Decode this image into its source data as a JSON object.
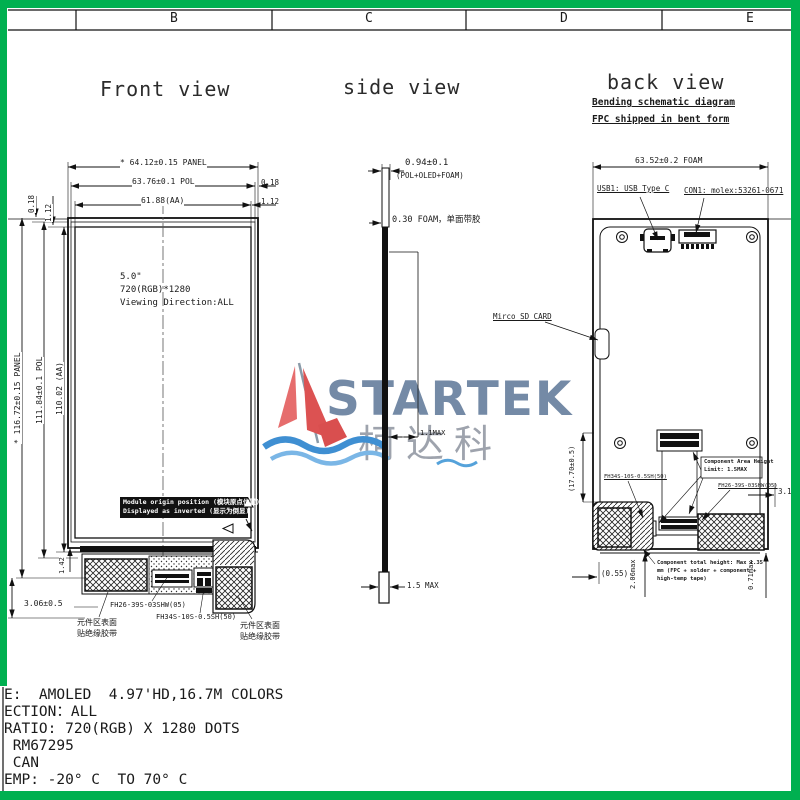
{
  "sheet": {
    "border_color": "#00b050",
    "columns": [
      "B",
      "C",
      "D",
      "E"
    ]
  },
  "front": {
    "title": "Front view",
    "size_label": "5.0\"",
    "resolution": "720(RGB)*1280",
    "viewing": "Viewing Direction:ALL",
    "dim_panel_w": "* 64.12±0.15 PANEL",
    "dim_pol_w": "63.76±0.1 POL",
    "dim_aa_w": "61.88(AA)",
    "gap_right_pol": "0.18",
    "gap_right_aa": "1.12",
    "gap_left_pol": "0.18",
    "gap_left_aa": "1.12",
    "dim_panel_h": "* 116.72±0.15 PANEL",
    "dim_pol_h": "111.84±0.1 POL",
    "dim_aa_h": "110.02 (AA)",
    "dim_ledge": "1.42",
    "dim_bottom": "15.12±0.5",
    "dim_tail": "3.06±0.5",
    "origin_line1": "Module origin position (模块原点位置)",
    "origin_line2": "Displayed as inverted (显示为倒显)",
    "conn1": "FH26-39S-03SHW(05)",
    "conn2": "FH34S-10S-0.5SH(50)",
    "tape_left_l1": "元件区表面",
    "tape_left_l2": "贴绝缘胶带",
    "tape_right_l1": "元件区表面",
    "tape_right_l2": "贴绝缘胶带"
  },
  "side": {
    "title": "side view",
    "dim_stack": "0.94±0.1",
    "dim_stack_sub": "(POL+OLED+FOAM)",
    "foam_note": "0.30 FOAM，单面带胶",
    "dim_mid": "1.1MAX",
    "dim_bottom": "1.5 MAX"
  },
  "back": {
    "title": "back view",
    "subtitle1": "Bending schematic diagram",
    "subtitle2": "FPC shipped in bent form",
    "dim_foam_w": "63.52±0.2 FOAM",
    "usb_label": "USB1: USB Type C",
    "con_label": "CON1: molex:53261-0671",
    "sd_label": "Mirco SD CARD",
    "dim_side": "(17.70±0.5)",
    "comp_area_l1": "Component Area Height",
    "comp_area_l2": "Limit: 1.5MAX",
    "fh34": "FH34S-10S-0.5SH(50)",
    "fh26": "FH26-39S-03SHW(05)",
    "dim_316": "3.16",
    "dim_055": "(0.55)",
    "dim_206": "2.06max",
    "dim_071": "0.71max",
    "note_l1": "Component total height: Max 1.35",
    "note_l2": "mm (FPC + solder + component +",
    "note_l3": "high-temp tape)"
  },
  "watermark": {
    "brand": "STARTEK",
    "brand_cn": "柯达科"
  },
  "specs": {
    "lines": [
      "E:  AMOLED  4.97'HD,16.7M COLORS",
      "ECTION：ALL",
      "RATIO: 720(RGB) X 1280 DOTS",
      " RM67295",
      " CAN",
      "EMP: -20° C  TO 70° C"
    ]
  }
}
